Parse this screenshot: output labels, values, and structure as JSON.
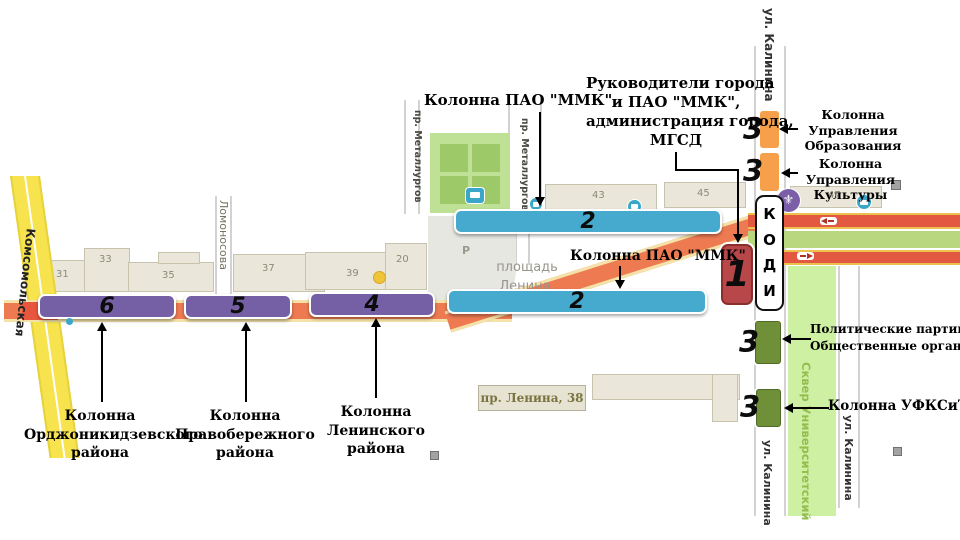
{
  "colors": {
    "column_purple": "#7560a6",
    "column_blue": "#46a9ce",
    "column_red": "#b8474a",
    "column_orange": "#f6a04b",
    "column_green": "#6f9038",
    "road_orange": "#ee7a52",
    "road_red": "#e25840",
    "road_yellow": "#f7e34d",
    "park_green": "#bfe196",
    "skver_green": "#cdf0a2"
  },
  "bars": {
    "bar6": "6",
    "bar5": "5",
    "bar4": "4",
    "bar2_top": "2",
    "bar2_bottom": "2",
    "box1": "1",
    "orange1": "3",
    "orange2": "3",
    "green1": "3",
    "green2": "3"
  },
  "kodi": [
    "К",
    "О",
    "Д",
    "И"
  ],
  "streets": {
    "kalinina_top": "ул. Калинина",
    "kalinina_sw": "ул. Калинина",
    "kalinina_se": "ул. Калинина",
    "komsomolskaya": "Комсомольская",
    "lomonosova": "Ломоносова",
    "metallurgov_w": "пр. Металлургов",
    "metallurgov_e": "пр. Металлургов",
    "skver": "Сквер Университетский",
    "square_line1": "площадь",
    "square_line2": "Ленина",
    "lenina38": "пр. Ленина, 38"
  },
  "buildings": {
    "b31": "31",
    "b33": "33",
    "b35": "35",
    "b37": "37",
    "b39": "39",
    "b20": "20",
    "b43": "43",
    "b45": "45",
    "b47": "47"
  },
  "icons": {
    "fleur": "⚜",
    "parking": "Р"
  },
  "callouts": {
    "mmk_top": "Колонна ПАО \"ММК\"",
    "mmk_mid": "Колонна ПАО \"ММК\"",
    "leaders": [
      "Руководители города",
      "и ПАО \"ММК\",",
      "администрация города,",
      "МГСД"
    ],
    "education": [
      "Колонна",
      "Управления",
      "Образования"
    ],
    "culture": [
      "Колонна",
      "Управления",
      "Культуры"
    ],
    "political": [
      "Политические партии,",
      "Общественные организации"
    ],
    "ufksit": "Колонна УФКСиТ",
    "district6": [
      "Колонна",
      "Орджоникидзевского",
      "района"
    ],
    "district5": [
      "Колонна",
      "Правобережного",
      "района"
    ],
    "district4": [
      "Колонна",
      "Ленинского",
      "района"
    ]
  }
}
